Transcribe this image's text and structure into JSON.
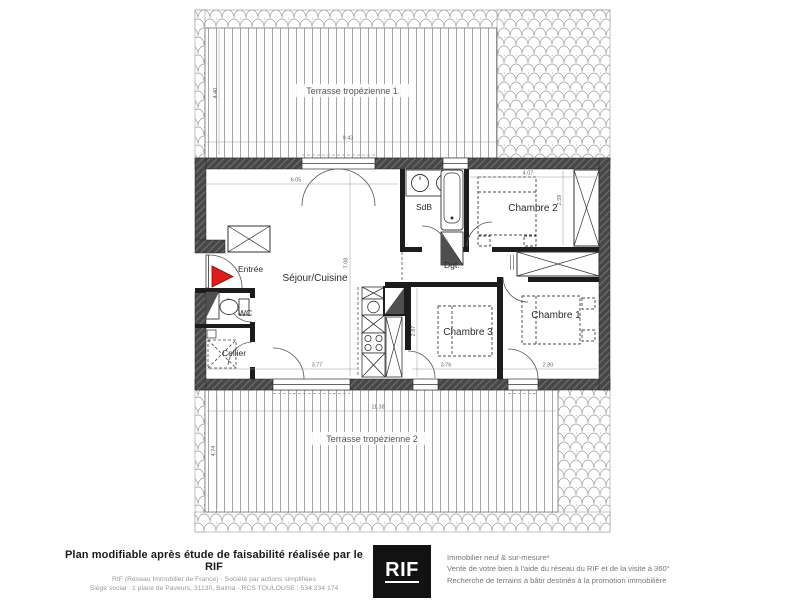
{
  "plan": {
    "rooms": {
      "terrace1": "Terrasse tropézienne 1",
      "terrace2": "Terrasse tropézienne 2",
      "sejour": "Séjour/Cuisine",
      "sdb": "SdB",
      "dgt": "Dgt.",
      "chambre1": "Chambre 1",
      "chambre2": "Chambre 2",
      "chambre3": "Chambre 3",
      "wc": "WC",
      "cellier": "Cellier",
      "entree": "Entrée"
    },
    "dims": {
      "t1_h": "4.40",
      "t1_w": "9.43",
      "sejour_w": "6.05",
      "sejour_h": "7.08",
      "ch2_w": "4.07",
      "ch2_h": "2.59",
      "sejour_bw": "3.77",
      "ch3_w": "3.76",
      "ch3_h": "2.87",
      "ch1_w": "2.80",
      "t2_w": "11.38",
      "t2_h": "4.74"
    },
    "colors": {
      "entry_arrow": "#e01b1b",
      "wall_dark": "#4a4a4a",
      "wall_interior": "#1c1c1c"
    }
  },
  "footer": {
    "left_bold": "Plan modifiable après étude de faisabilité réalisée par le RIF",
    "left_line2": "RIF (Réseau Immobilier de France) - Société par actions simplifiées",
    "left_line3": "Siège social : 1 place de Paveurs, 31130, Balma - RCS TOULOUSE : 534 234 174",
    "logo_text": "RIF",
    "right_line1": "Immobilier neuf & sur-mesure*",
    "right_line2": "Vente de votre bien à l'aide du réseau du RIF et de la visite à 360°",
    "right_line3": "Recherche de terrains à bâtir destinés à la promotion immobilière"
  }
}
